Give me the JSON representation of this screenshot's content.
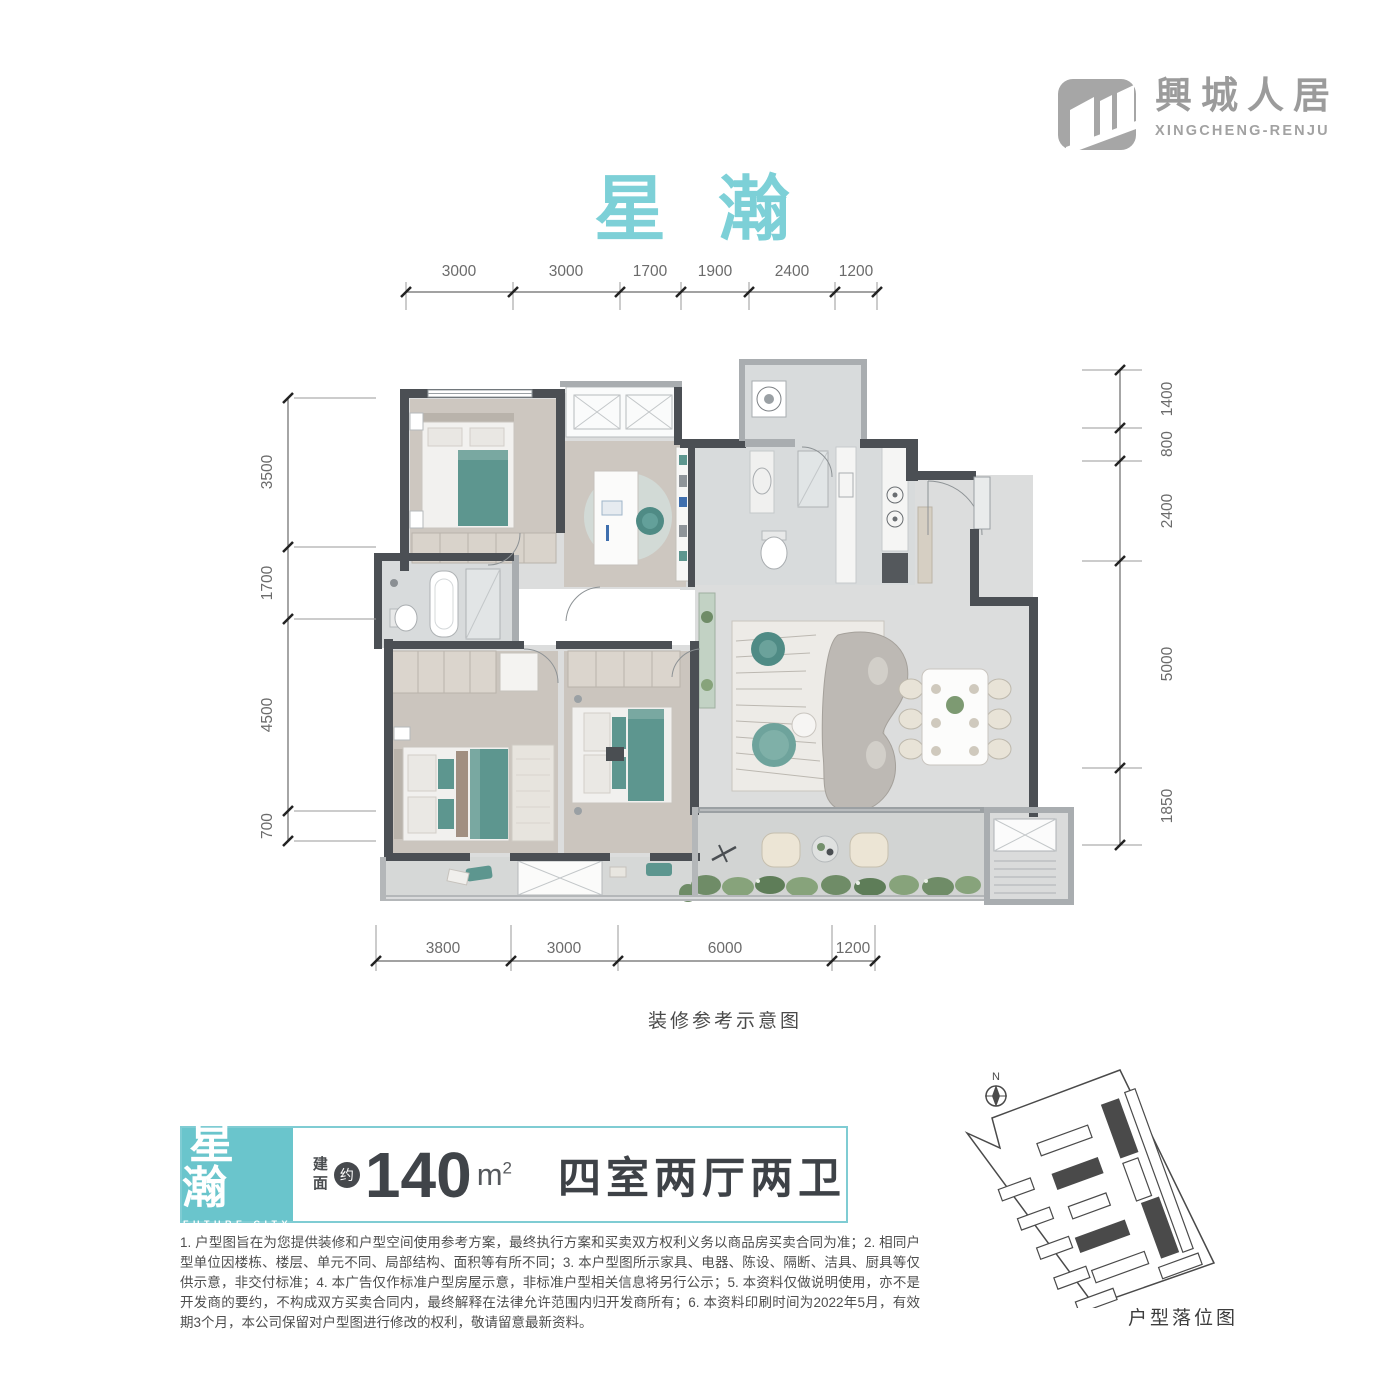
{
  "brand": {
    "name_cn": "興城人居",
    "name_en": "XINGCHENG-RENJU"
  },
  "title": "星 瀚",
  "plan": {
    "caption": "装修参考示意图",
    "dims_top": [
      "3000",
      "3000",
      "1700",
      "1900",
      "2400",
      "1200"
    ],
    "dims_bottom": [
      "3800",
      "3000",
      "6000",
      "1200"
    ],
    "dims_left": [
      "3500",
      "1700",
      "4500",
      "700"
    ],
    "dims_right": [
      "1400",
      "800",
      "2400",
      "5000",
      "1850"
    ]
  },
  "info": {
    "badge_cn": "星瀚",
    "badge_en": "FUTURE CITY",
    "area_label_1": "建",
    "area_label_2": "面",
    "area_approx": "约",
    "area_value": "140",
    "area_unit": "m",
    "area_sup": "2",
    "layout": "四室两厅两卫"
  },
  "disclaimer": "1. 户型图旨在为您提供装修和户型空间使用参考方案，最终执行方案和买卖双方权利义务以商品房买卖合同为准；2. 相同户型单位因楼栋、楼层、单元不同、局部结构、面积等有所不同；3. 本户型图所示家具、电器、陈设、隔断、洁具、厨具等仅供示意，非交付标准；4. 本广告仅作标准户型房屋示意，非标准户型相关信息将另行公示；5. 本资料仅做说明使用，亦不是开发商的要约，不构成双方买卖合同内，最终解释在法律允许范围内归开发商所有；6. 本资料印刷时间为2022年5月，有效期3个月，本公司保留对户型图进行修改的权利，敬请留意最新资料。",
  "site": {
    "caption": "户型落位图",
    "compass": "N"
  },
  "colors": {
    "title_teal": "#7dd0d7",
    "badge_teal": "#6ac5cc",
    "wall_dark": "#4b4f54",
    "furniture_teal": "#5d968f",
    "brand_gray": "#9b9b9b",
    "text_dark": "#3f4347"
  }
}
